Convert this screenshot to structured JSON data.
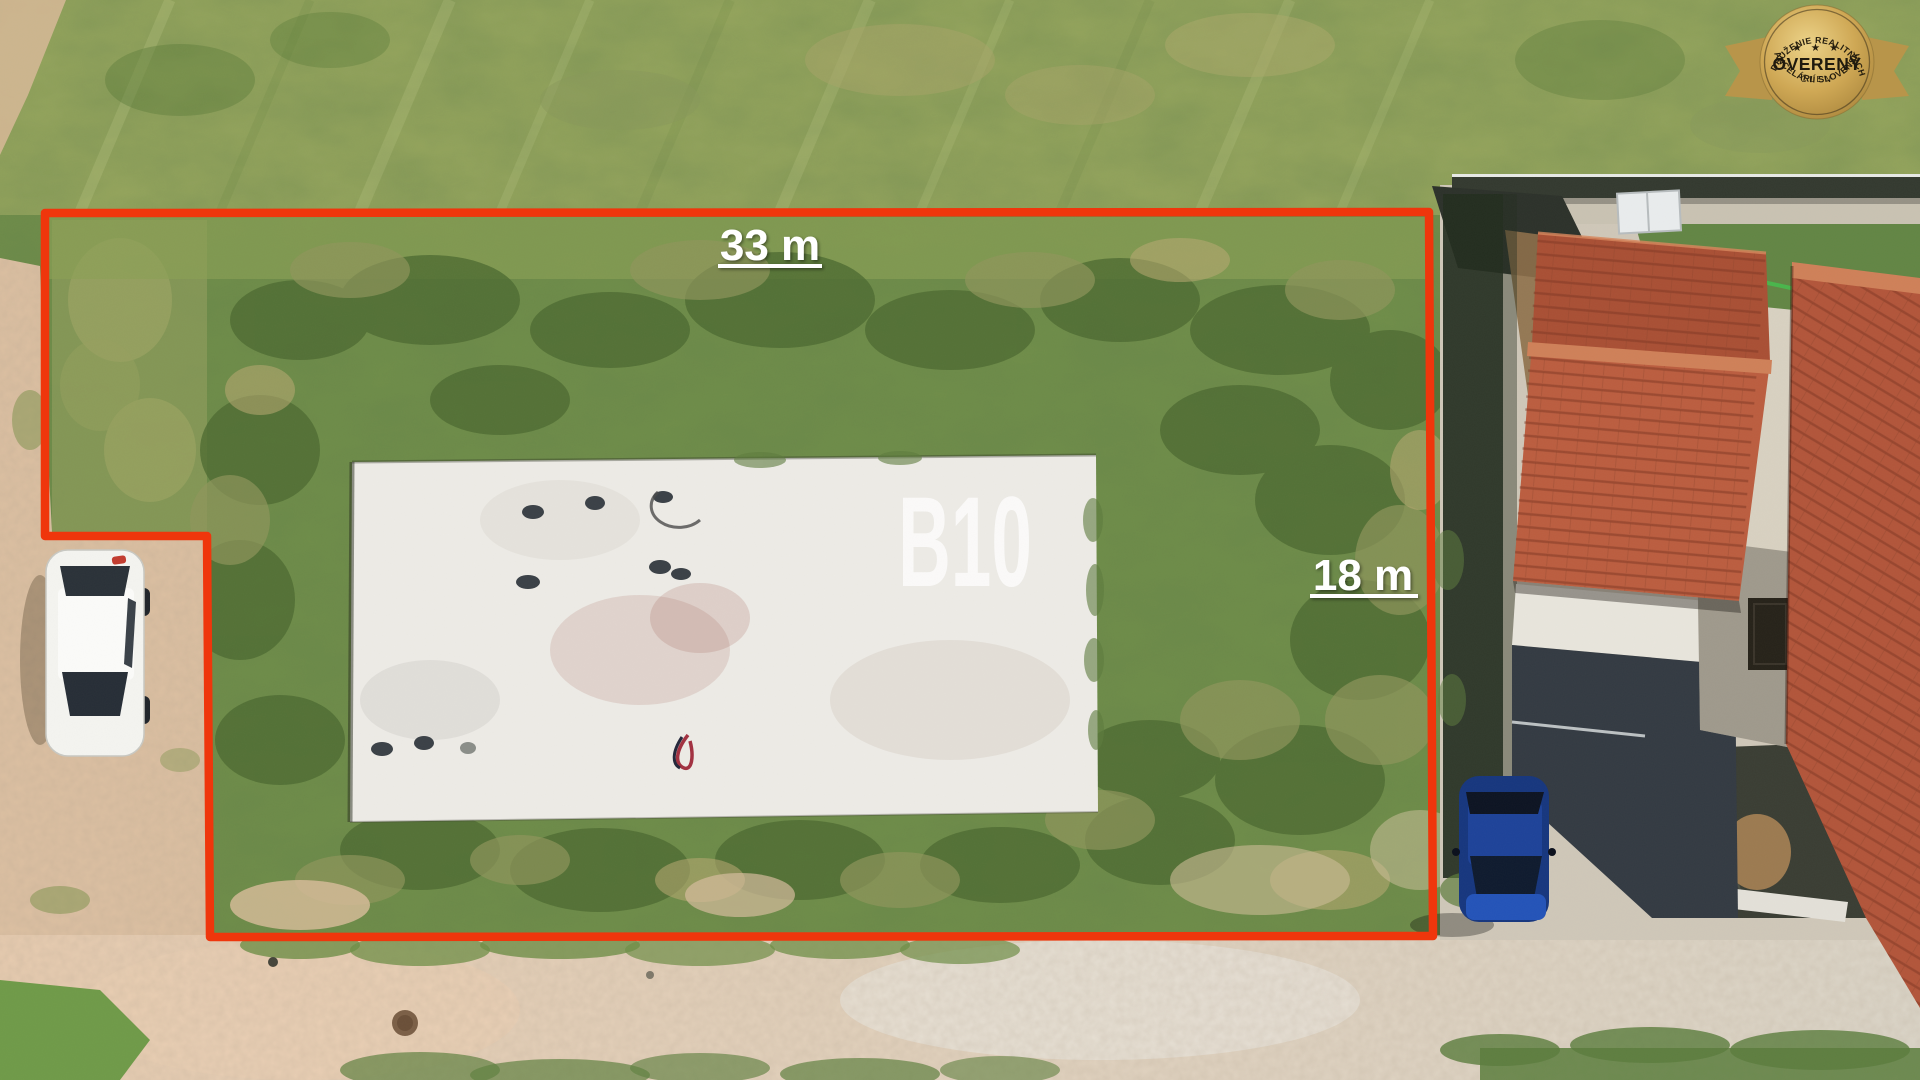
{
  "scene": {
    "annotations": {
      "width_label": "33 m",
      "depth_label": "18 m",
      "plot_code": "B10",
      "boundary_color": "#ef360c",
      "label_color": "#ffffff"
    },
    "features": {
      "grass_color": "#6f8d48",
      "dirt_road_color": "#ddc0a2",
      "concrete_slab_color": "#edebe6",
      "roof_color": "#b5573a",
      "white_car_color": "#f2f2ee",
      "blue_car_color": "#1d3f96"
    }
  },
  "badge": {
    "arc_top": "ZDRUŽENIE REALITNÝCH",
    "stars": "★ ★ ★",
    "title": "OVERENÝ",
    "subtitle": "ČLEN",
    "arc_bottom": "KANCELÁRIÍ SLOVENSKA",
    "gold_color": "#c8a350",
    "text_color": "#241d0e"
  }
}
